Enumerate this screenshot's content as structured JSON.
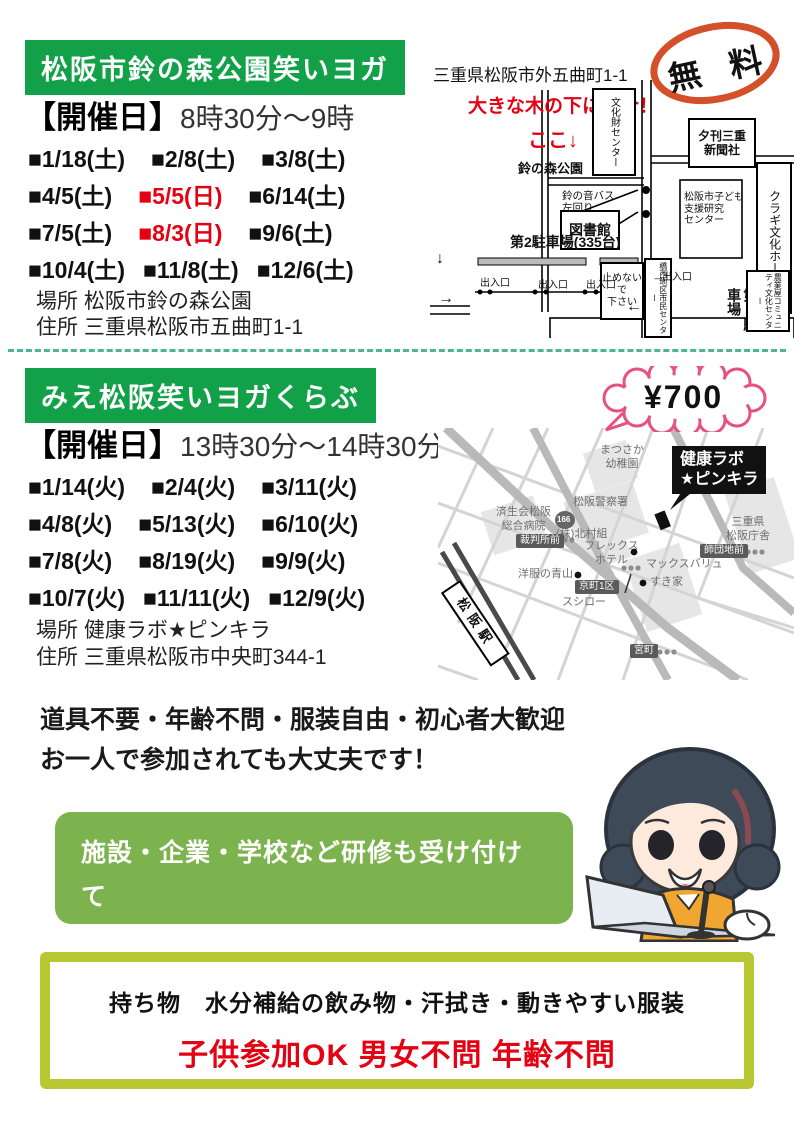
{
  "flyer": {
    "section1": {
      "title": "松阪市鈴の森公園笑いヨガ",
      "schedule_label": "【開催日】",
      "schedule_time": "8時30分～9時",
      "dates": [
        "■1/18(土)",
        "■2/8(土)",
        "■3/8(土)",
        "■4/5(土)",
        "■5/5(日)",
        "■6/14(土)",
        "■7/5(土)",
        "■8/3(日)",
        "■9/6(土)",
        "■10/4(土)",
        "■11/8(土)",
        "■12/6(土)"
      ],
      "place": "場所 松阪市鈴の森公園",
      "address": "住所 三重県松阪市五曲町1-1",
      "free_badge": "無 料",
      "map": {
        "address": "三重県松阪市外五曲町1-1",
        "meet": "大きな木の下に集合！",
        "here": "ここ↓",
        "park": "鈴の森公園",
        "bunkazai_center": "文化財センター",
        "newspaper": "夕刊三重\n新聞社",
        "bus_left": "鈴の音バス\n左回り",
        "bus_right": "鈴の音バス\n右回り",
        "kodomo_center": "松阪市子ども\n支援研究\nセンター",
        "kuragi_hall": "クラギ文化ホール",
        "library": "図書館",
        "parking2": "第2駐車場(335台)",
        "no_parking": "止めないで\n下さい",
        "kyosei_center": "橋西地区市民センター",
        "exit": "出入口",
        "parking1": "第1駐車場",
        "nogyo_center": "農業屋コミュニティ文化センター",
        "arrow_down": "↓",
        "arrow_right": "→",
        "arrow_left": "←"
      }
    },
    "section2": {
      "title": "みえ松阪笑いヨガくらぶ",
      "schedule_label": "【開催日】",
      "schedule_time": "13時30分～14時30分",
      "dates": [
        "■1/14(火)",
        "■2/4(火)",
        "■3/11(火)",
        "■4/8(火)",
        "■5/13(火)",
        "■6/10(火)",
        "■7/8(火)",
        "■8/19(火)",
        "■9/9(火)",
        "■10/7(火)",
        "■11/11(火)",
        "■12/9(火)"
      ],
      "place": "場所 健康ラボ★ピンキラ",
      "address": "住所 三重県松阪市中央町344-1",
      "fee_badge": "¥700",
      "map": {
        "kindergarten": "まつさか\n幼稚園",
        "kenko_lab": "健康ラボ\n★ピンキラ",
        "police": "松阪警察署",
        "kitamura": "(株)北村組",
        "prefecture_office": "三重県\n松阪庁舎",
        "hospital": "済生会松阪\n総合病院",
        "route_166": "166",
        "courthouse_stop": "裁判所前",
        "flex_hotel": "フレックス\nホテル",
        "aoyama": "洋服の青山",
        "kyomachi_stop": "京町1区",
        "sushiro": "スシロー",
        "maxvalu": "マックスバリュ",
        "sukiya": "すき家",
        "danchi_stop": "師団地前",
        "miyamachi_stop": "宮町",
        "station": "松阪駅"
      }
    },
    "notes": {
      "line1": "道具不要・年齢不問・服装自由・初心者大歓迎",
      "line2": "お一人で参加されても大丈夫です！"
    },
    "contact_box": {
      "line1": "施設・企業・学校など研修も受け付けて",
      "line2": "います・気軽にお問い合わせ下さい"
    },
    "bottom_box": {
      "items": "持ち物　水分補給の飲み物・汗拭き・動きやすい服装",
      "note": "子供参加OK 男女不問 年齢不問"
    },
    "colors": {
      "banner_green": "#12a149",
      "contact_green": "#7cb34e",
      "frame_green": "#b9c832",
      "date_red": "#e50012",
      "free_circle_red": "#d4502a",
      "fee_bubble_pink": "#e8517e",
      "divider_teal": "#4db399"
    }
  }
}
